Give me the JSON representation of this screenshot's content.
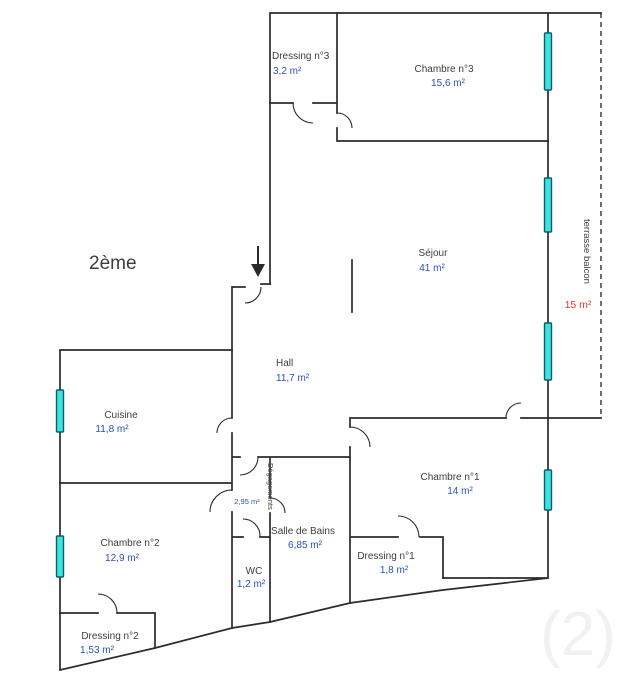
{
  "floor_label": "2ème",
  "colors": {
    "wall": "#2b2b2b",
    "room_name": "#3d3d3d",
    "area_value": "#2b50c0",
    "terrace_area": "#e03a3a",
    "window_fill": "#3fe2e2",
    "window_border": "#0b5f66",
    "dashed_boundary": "#4a4a4a",
    "watermark": "#f1f1f1"
  },
  "rooms": {
    "dressing3": {
      "name": "Dressing n°3",
      "area": "3,2 m²"
    },
    "chambre3": {
      "name": "Chambre n°3",
      "area": "15,6 m²"
    },
    "sejour": {
      "name": "Séjour",
      "area": "41 m²"
    },
    "hall": {
      "name": "Hall",
      "area": "11,7 m²"
    },
    "cuisine": {
      "name": "Cuisine",
      "area": "11,8 m²"
    },
    "chambre2": {
      "name": "Chambre n°2",
      "area": "12,9 m²"
    },
    "dressing2": {
      "name": "Dressing n°2",
      "area": "1,53 m²"
    },
    "wc": {
      "name": "WC",
      "area": "1,2 m²"
    },
    "salle_de_bains": {
      "name": "Salle de Bains",
      "area": "6,85 m²"
    },
    "degagements": {
      "name": "Dégagements",
      "area": "2,95 m²"
    },
    "dressing1": {
      "name": "Dressing n°1",
      "area": "1,8 m²"
    },
    "chambre1": {
      "name": "Chambre n°1",
      "area": "14 m²"
    }
  },
  "terrace": {
    "name": "terrasse balcon",
    "area": "15 m²"
  },
  "watermark": "(2)"
}
